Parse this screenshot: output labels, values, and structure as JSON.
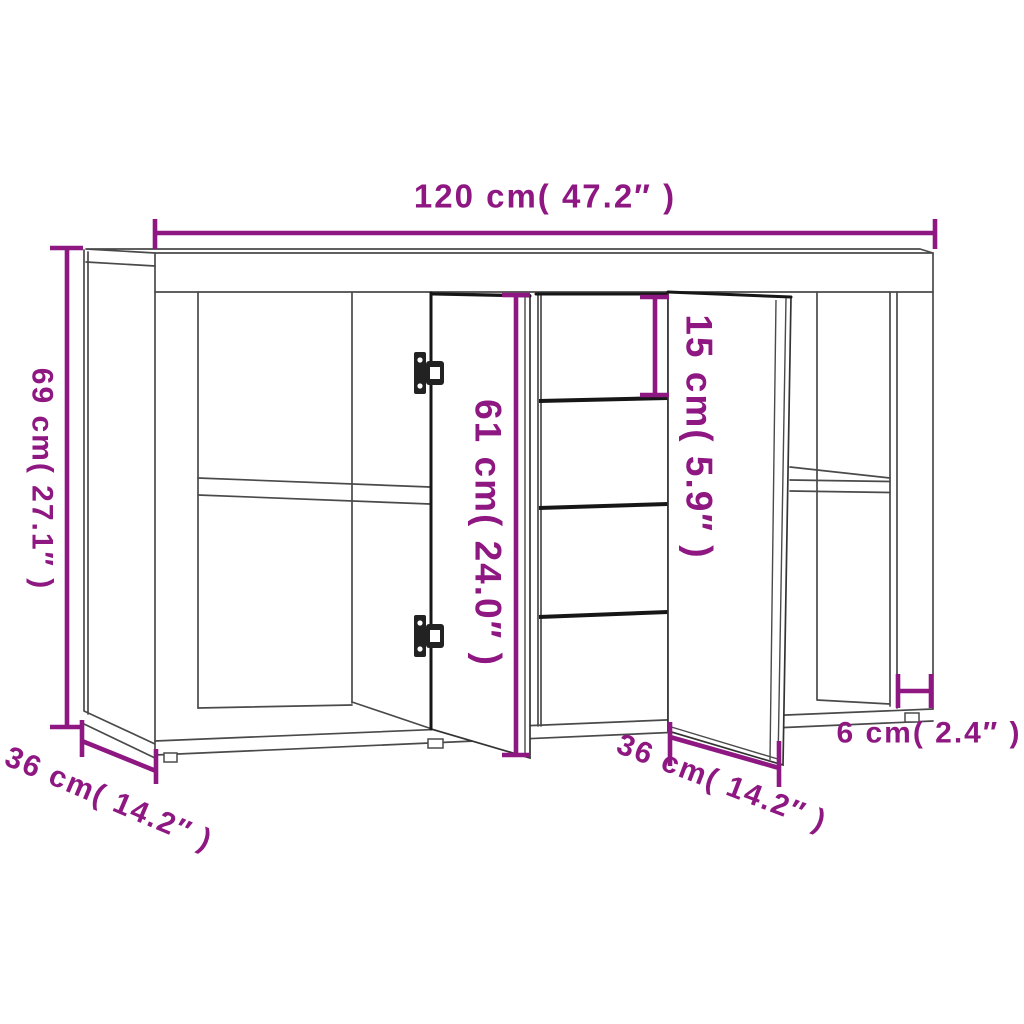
{
  "diagram": {
    "labels": {
      "overall_width": "120 cm( 47.2″ )",
      "overall_height": "69 cm( 27.1″ )",
      "door_height": "61 cm( 24.0″ )",
      "top_drawer_height": "15 cm( 5.9″ )",
      "depth": "36 cm( 14.2″ )",
      "middle_door_width": "36 cm( 14.2″ )",
      "right_side_depth": "6 cm( 2.4″ )"
    }
  },
  "colors": {
    "dimension_accent": "#8E1782",
    "cabinet_line": "#4a4a4a",
    "cabinet_dark_line": "#161616",
    "background": "#ffffff"
  }
}
